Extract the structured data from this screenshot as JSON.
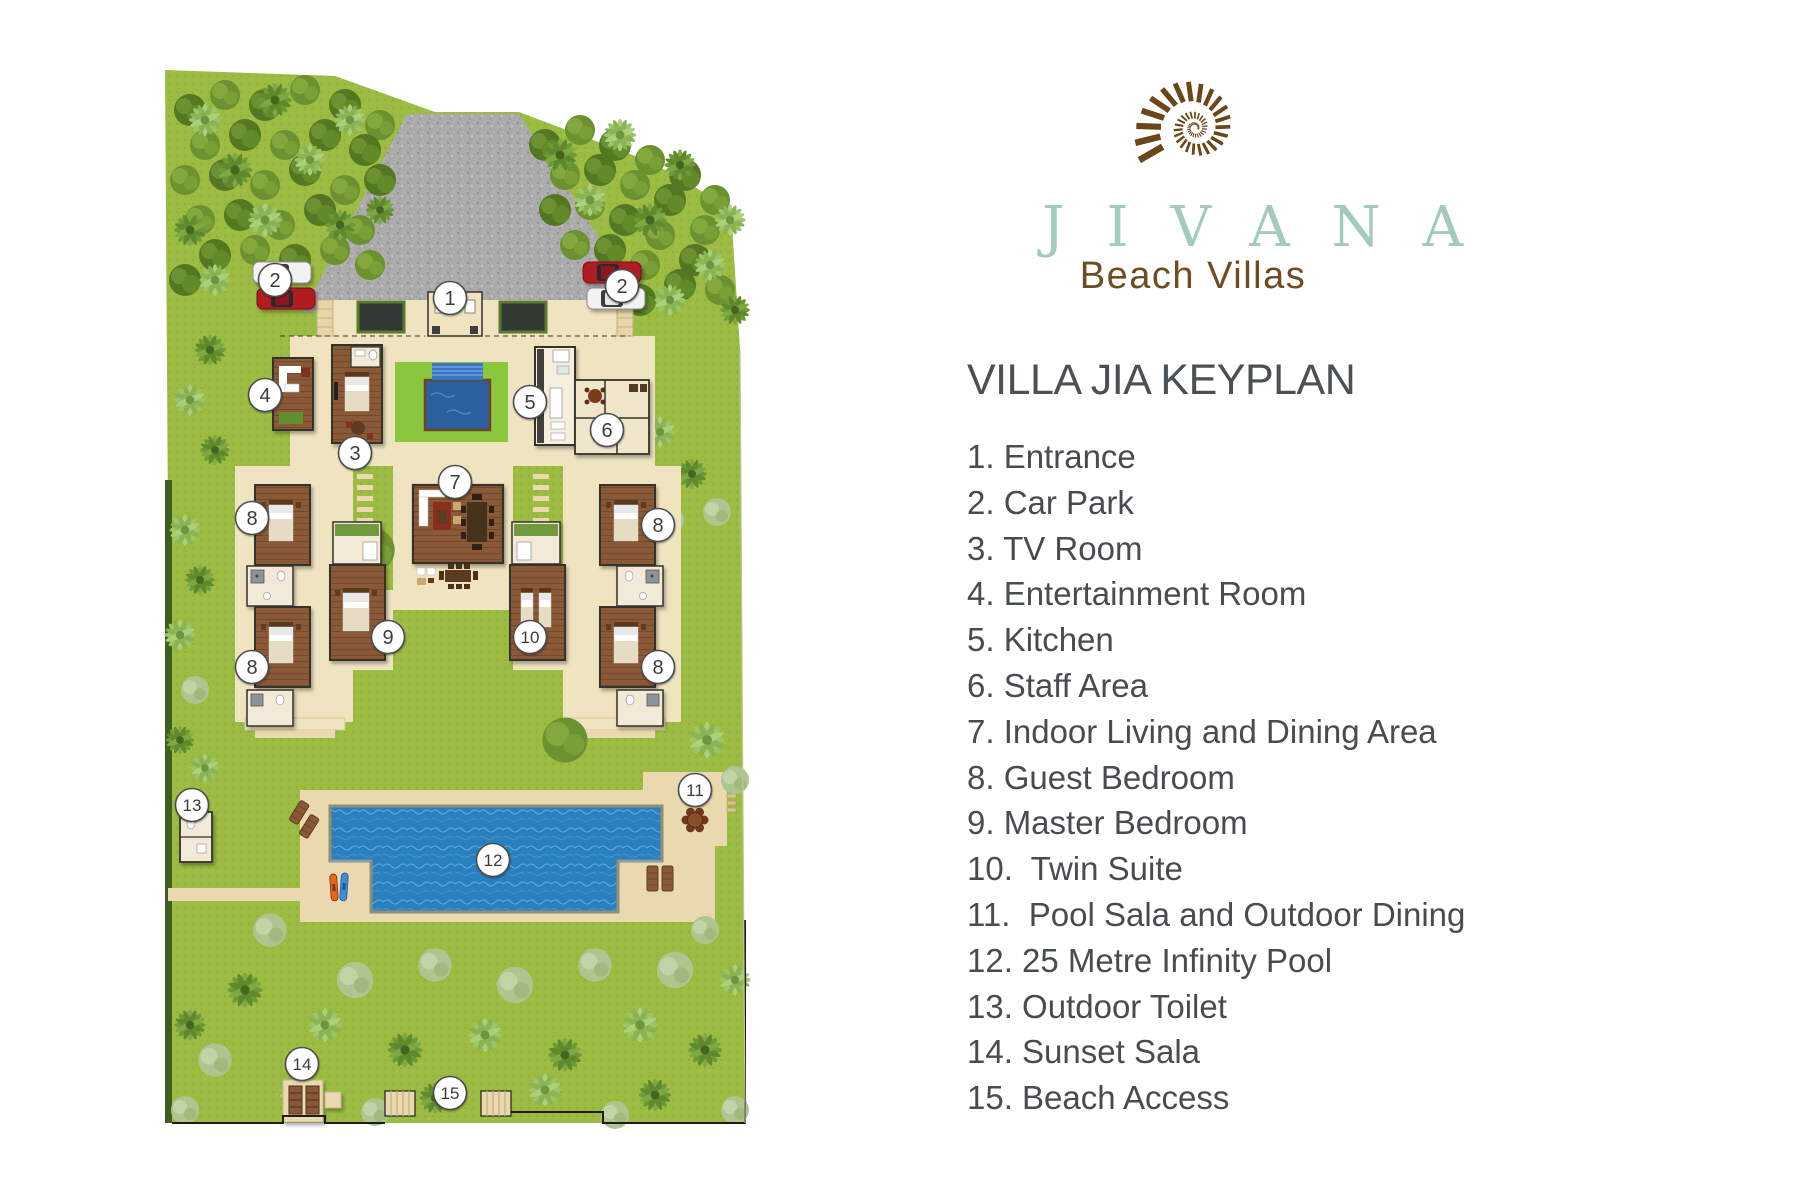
{
  "brand": {
    "name": "JIVANA",
    "subtitle": "Beach Villas",
    "logo_icon": "nautilus-shell-spiral"
  },
  "title": "VILLA JIA KEYPLAN",
  "legend": {
    "items": [
      "1. Entrance",
      "2. Car Park",
      "3. TV Room",
      "4. Entertainment Room",
      "5. Kitchen",
      "6. Staff Area",
      "7. Indoor Living and Dining Area",
      "8. Guest Bedroom",
      "9. Master Bedroom",
      "10.  Twin Suite",
      "11.  Pool Sala and Outdoor Dining",
      "12. 25 Metre Infinity Pool",
      "13. Outdoor Toilet",
      "14. Sunset Sala",
      "15. Beach Access"
    ]
  },
  "site_plan": {
    "markers": [
      {
        "label": "1",
        "title": "Entrance",
        "x": 355,
        "y": 248
      },
      {
        "label": "2",
        "title": "Car Park",
        "x": 180,
        "y": 230
      },
      {
        "label": "2",
        "title": "Car Park",
        "x": 527,
        "y": 236
      },
      {
        "label": "3",
        "title": "TV Room",
        "x": 260,
        "y": 403
      },
      {
        "label": "4",
        "title": "Entertainment Room",
        "x": 170,
        "y": 345
      },
      {
        "label": "5",
        "title": "Kitchen",
        "x": 435,
        "y": 352
      },
      {
        "label": "6",
        "title": "Staff Area",
        "x": 512,
        "y": 380
      },
      {
        "label": "7",
        "title": "Indoor Living and Dining Area",
        "x": 360,
        "y": 432
      },
      {
        "label": "8",
        "title": "Guest Bedroom",
        "x": 157,
        "y": 468
      },
      {
        "label": "8",
        "title": "Guest Bedroom",
        "x": 563,
        "y": 475
      },
      {
        "label": "8",
        "title": "Guest Bedroom",
        "x": 157,
        "y": 617
      },
      {
        "label": "8",
        "title": "Guest Bedroom",
        "x": 563,
        "y": 617
      },
      {
        "label": "9",
        "title": "Master Bedroom",
        "x": 293,
        "y": 587
      },
      {
        "label": "10",
        "title": "Twin Suite",
        "x": 435,
        "y": 587
      },
      {
        "label": "11",
        "title": "Pool Sala and Outdoor Dining",
        "x": 600,
        "y": 740
      },
      {
        "label": "12",
        "title": "25 Metre Infinity Pool",
        "x": 398,
        "y": 810
      },
      {
        "label": "13",
        "title": "Outdoor Toilet",
        "x": 97,
        "y": 755
      },
      {
        "label": "14",
        "title": "Sunset Sala",
        "x": 207,
        "y": 1014
      },
      {
        "label": "15",
        "title": "Beach Access",
        "x": 355,
        "y": 1043
      }
    ],
    "colors": {
      "brand_teal": "#a3cbba",
      "brand_brown": "#6b4617",
      "text": "#474c4f",
      "lawn": "#9cbb43",
      "pool_blue": "#2a80be",
      "wood_brown": "#8a5a38",
      "hardscape_cream": "#efe3c0",
      "driveway_grey": "#ababab"
    }
  }
}
